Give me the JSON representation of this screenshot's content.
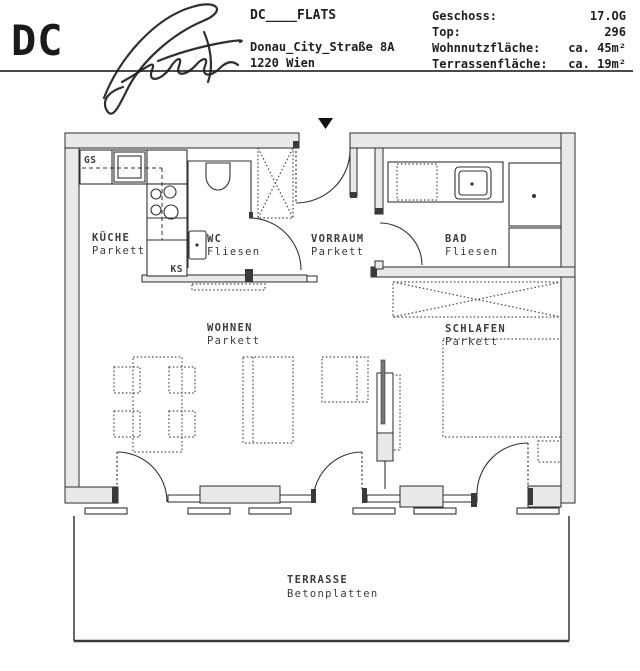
{
  "header": {
    "logo_text": "DC",
    "logo_script": "Flats",
    "project_name": "DC____FLATS",
    "address_line1": "Donau_City_Straße 8A",
    "address_line2": "1220 Wien",
    "details": [
      {
        "label": "Geschoss:",
        "value": "17.OG"
      },
      {
        "label": "Top:",
        "value": "296"
      },
      {
        "label": "Wohnnutzfläche:",
        "value": "ca. 45m²"
      },
      {
        "label": "Terrassenfläche:",
        "value": "ca. 19m²"
      }
    ]
  },
  "floorplan": {
    "rooms": {
      "kueche": {
        "name": "KÜCHE",
        "material": "Parkett"
      },
      "wc": {
        "name": "WC",
        "material": "Fliesen"
      },
      "vorraum": {
        "name": "VORRAUM",
        "material": "Parkett"
      },
      "bad": {
        "name": "BAD",
        "material": "Fliesen"
      },
      "wohnen": {
        "name": "WOHNEN",
        "material": "Parkett"
      },
      "schlafen": {
        "name": "SCHLAFEN",
        "material": "Parkett"
      },
      "terrasse": {
        "name": "TERRASSE",
        "material": "Betonplatten"
      }
    },
    "appliances": {
      "dishwasher": "GS",
      "fridge": "KS"
    },
    "colors": {
      "wall_fill": "#e9e9e9",
      "line": "#2e2e2e",
      "text": "#3c3c3c"
    }
  }
}
